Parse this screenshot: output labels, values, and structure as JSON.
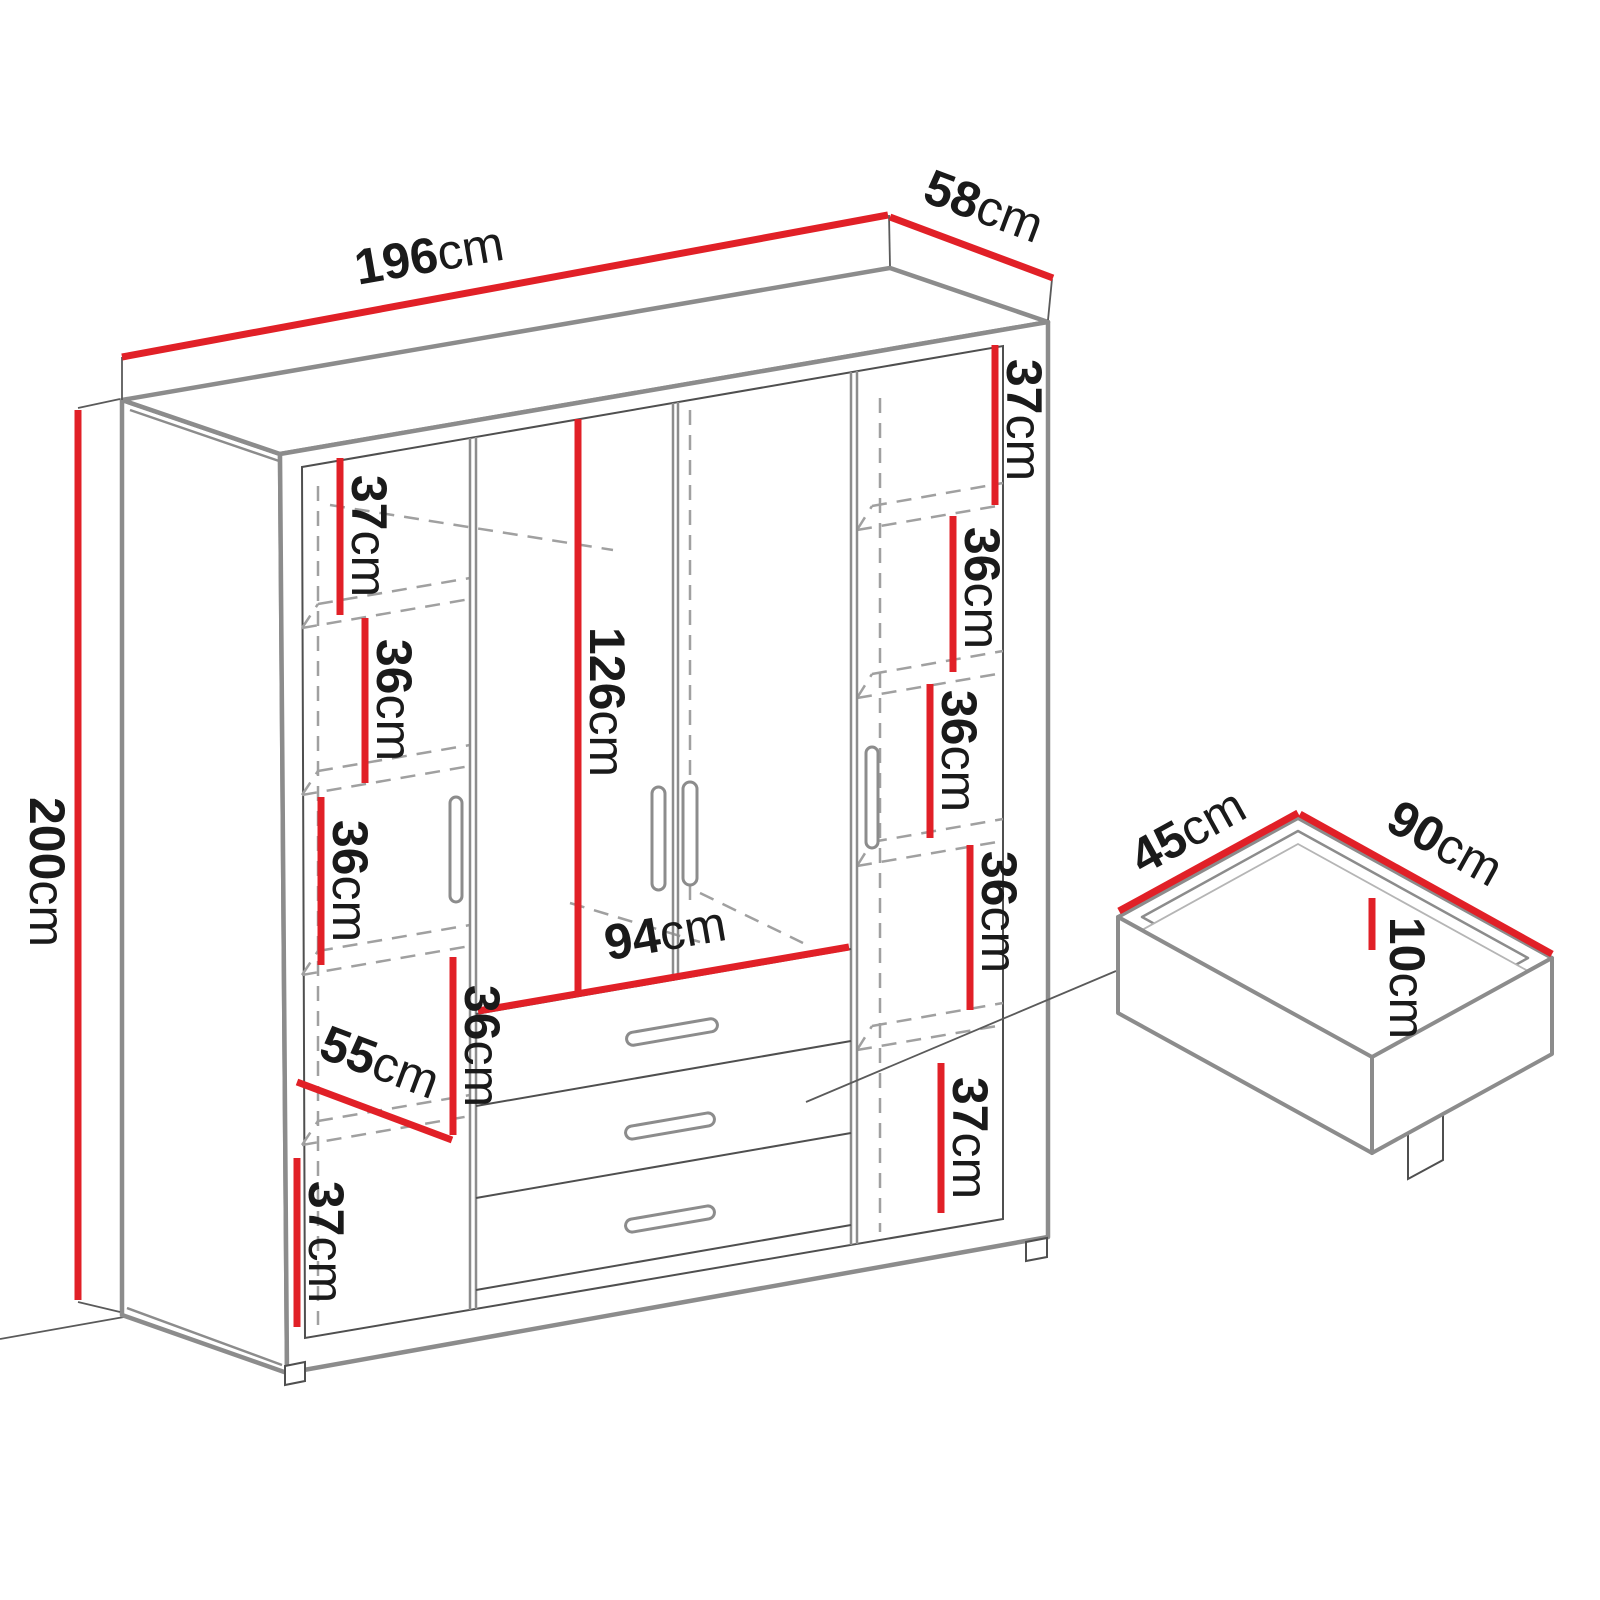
{
  "colors": {
    "accent": "#e12027",
    "line": "#8c8c8c",
    "line-dark": "#4f4f4f",
    "dash": "#a0a0a0",
    "text": "#1a1a1a",
    "bg": "#ffffff"
  },
  "dims": {
    "width": {
      "v": "196",
      "u": "cm"
    },
    "depth": {
      "v": "58",
      "u": "cm"
    },
    "height": {
      "v": "200",
      "u": "cm"
    },
    "left_shelf_1": {
      "v": "37",
      "u": "cm"
    },
    "left_shelf_2": {
      "v": "36",
      "u": "cm"
    },
    "left_shelf_3": {
      "v": "36",
      "u": "cm"
    },
    "left_shelf_4": {
      "v": "36",
      "u": "cm"
    },
    "left_width": {
      "v": "55",
      "u": "cm"
    },
    "left_shelf_5": {
      "v": "37",
      "u": "cm"
    },
    "center_height": {
      "v": "126",
      "u": "cm"
    },
    "center_width": {
      "v": "94",
      "u": "cm"
    },
    "right_shelf_1": {
      "v": "37",
      "u": "cm"
    },
    "right_shelf_2": {
      "v": "36",
      "u": "cm"
    },
    "right_shelf_3": {
      "v": "36",
      "u": "cm"
    },
    "right_shelf_4": {
      "v": "36",
      "u": "cm"
    },
    "right_shelf_5": {
      "v": "37",
      "u": "cm"
    },
    "drawer_depth": {
      "v": "45",
      "u": "cm"
    },
    "drawer_width": {
      "v": "90",
      "u": "cm"
    },
    "drawer_height": {
      "v": "10",
      "u": "cm"
    }
  }
}
